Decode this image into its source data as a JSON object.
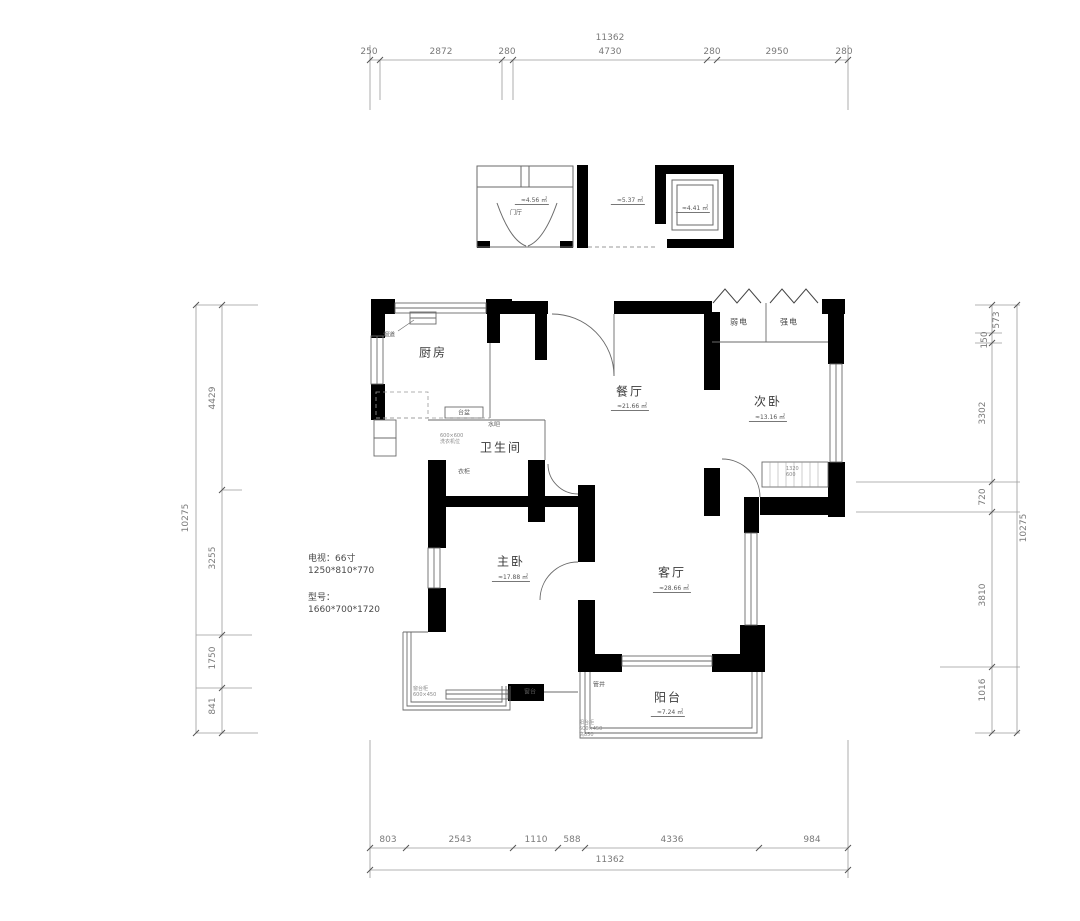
{
  "plan": {
    "dimensions": {
      "top": {
        "total": "11362",
        "segs": [
          "250",
          "2872",
          "280",
          "4730",
          "280",
          "2950",
          "280"
        ]
      },
      "bottom": {
        "total": "11362",
        "segs": [
          "803",
          "2543",
          "1110",
          "588",
          "4336",
          "984"
        ]
      },
      "left": {
        "total": "10275",
        "segs": [
          "4429",
          "3255",
          "1750",
          "841"
        ]
      },
      "right": {
        "total": "10275",
        "segs": [
          "573",
          "150",
          "3302",
          "720",
          "3810",
          "1016"
        ]
      }
    },
    "rooms": {
      "kitchen": {
        "label": "厨房"
      },
      "dining": {
        "label": "餐厅",
        "area": "≈21.66 ㎡"
      },
      "bedroom2": {
        "label": "次卧",
        "area": "≈13.16 ㎡"
      },
      "bathroom": {
        "label": "卫生间"
      },
      "master": {
        "label": "主卧",
        "area": "≈17.88 ㎡"
      },
      "living": {
        "label": "客厅",
        "area": "≈28.66 ㎡"
      },
      "balcony": {
        "label": "阳台",
        "area": "≈7.24 ㎡"
      },
      "entry": {
        "label": "门厅",
        "area": "≈4.56 ㎡"
      },
      "corridor": {
        "area": "≈5.37 ㎡"
      },
      "elevator": {
        "area": "≈4.41 ㎡"
      }
    },
    "closet": {
      "weak": "弱电",
      "strong": "强电"
    },
    "annotations": {
      "tv_line1": "电视：66寸",
      "tv_line2": "1250*810*770",
      "model_line1": "型号：",
      "model_line2": "1660*700*1720",
      "flue": "烟道",
      "waterbar": "水吧",
      "basin": "台盆",
      "wardrobe_small": "衣柜",
      "washer_l1": "600×600",
      "washer_l2": "洗衣机位",
      "sill": "窗台",
      "duct": "管井",
      "bay_l1": "窗台柜",
      "bay_l2": "600×450",
      "bal_l1": "阳台柜",
      "bal_l2": "600×450",
      "bal_l3": "高850",
      "wr_dim1": "1320",
      "wr_dim2": "600"
    }
  }
}
